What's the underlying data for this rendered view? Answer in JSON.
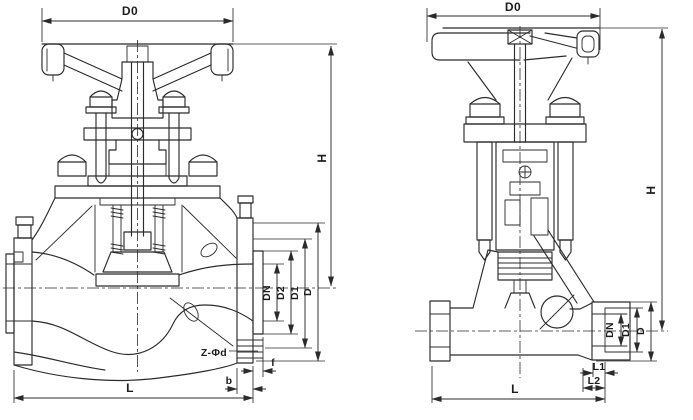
{
  "figure": {
    "background": "#ffffff",
    "line_color": "#2b2b2b",
    "views": {
      "left": {
        "name": "flanged globe valve, front section view",
        "dims": {
          "d0": "D0",
          "h": "H",
          "dn": "DN",
          "d2": "D2",
          "d1": "D1",
          "d": "D",
          "bolt_holes": "Z-Φd",
          "b": "b",
          "f": "f",
          "l": "L"
        }
      },
      "right": {
        "name": "socket-weld globe valve, side section view",
        "dims": {
          "d0": "D0",
          "h": "H",
          "dn": "DN",
          "d1": "D1",
          "d": "D",
          "l1": "L1",
          "l2": "L2",
          "l": "L"
        }
      }
    }
  }
}
